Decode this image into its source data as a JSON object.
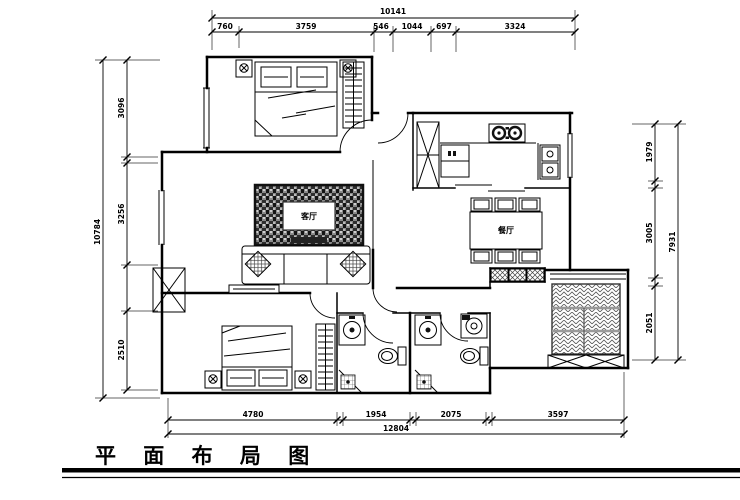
{
  "title": {
    "text": "平 面 布 局 图"
  },
  "labels": {
    "living_room": "客厅",
    "dining_room": "餐厅"
  },
  "dimensions": {
    "top": {
      "total": "10141",
      "segments": [
        "760",
        "3759",
        "546",
        "1044",
        "697",
        "3324"
      ]
    },
    "bottom": {
      "total": "12804",
      "segments": [
        "4780",
        "1954",
        "2075",
        "3597"
      ]
    },
    "left": {
      "total": "10784",
      "segments": [
        "3096",
        "3256",
        "2510"
      ]
    },
    "right": {
      "total": "7931",
      "segments": [
        "1979",
        "3005",
        "2051"
      ]
    }
  }
}
